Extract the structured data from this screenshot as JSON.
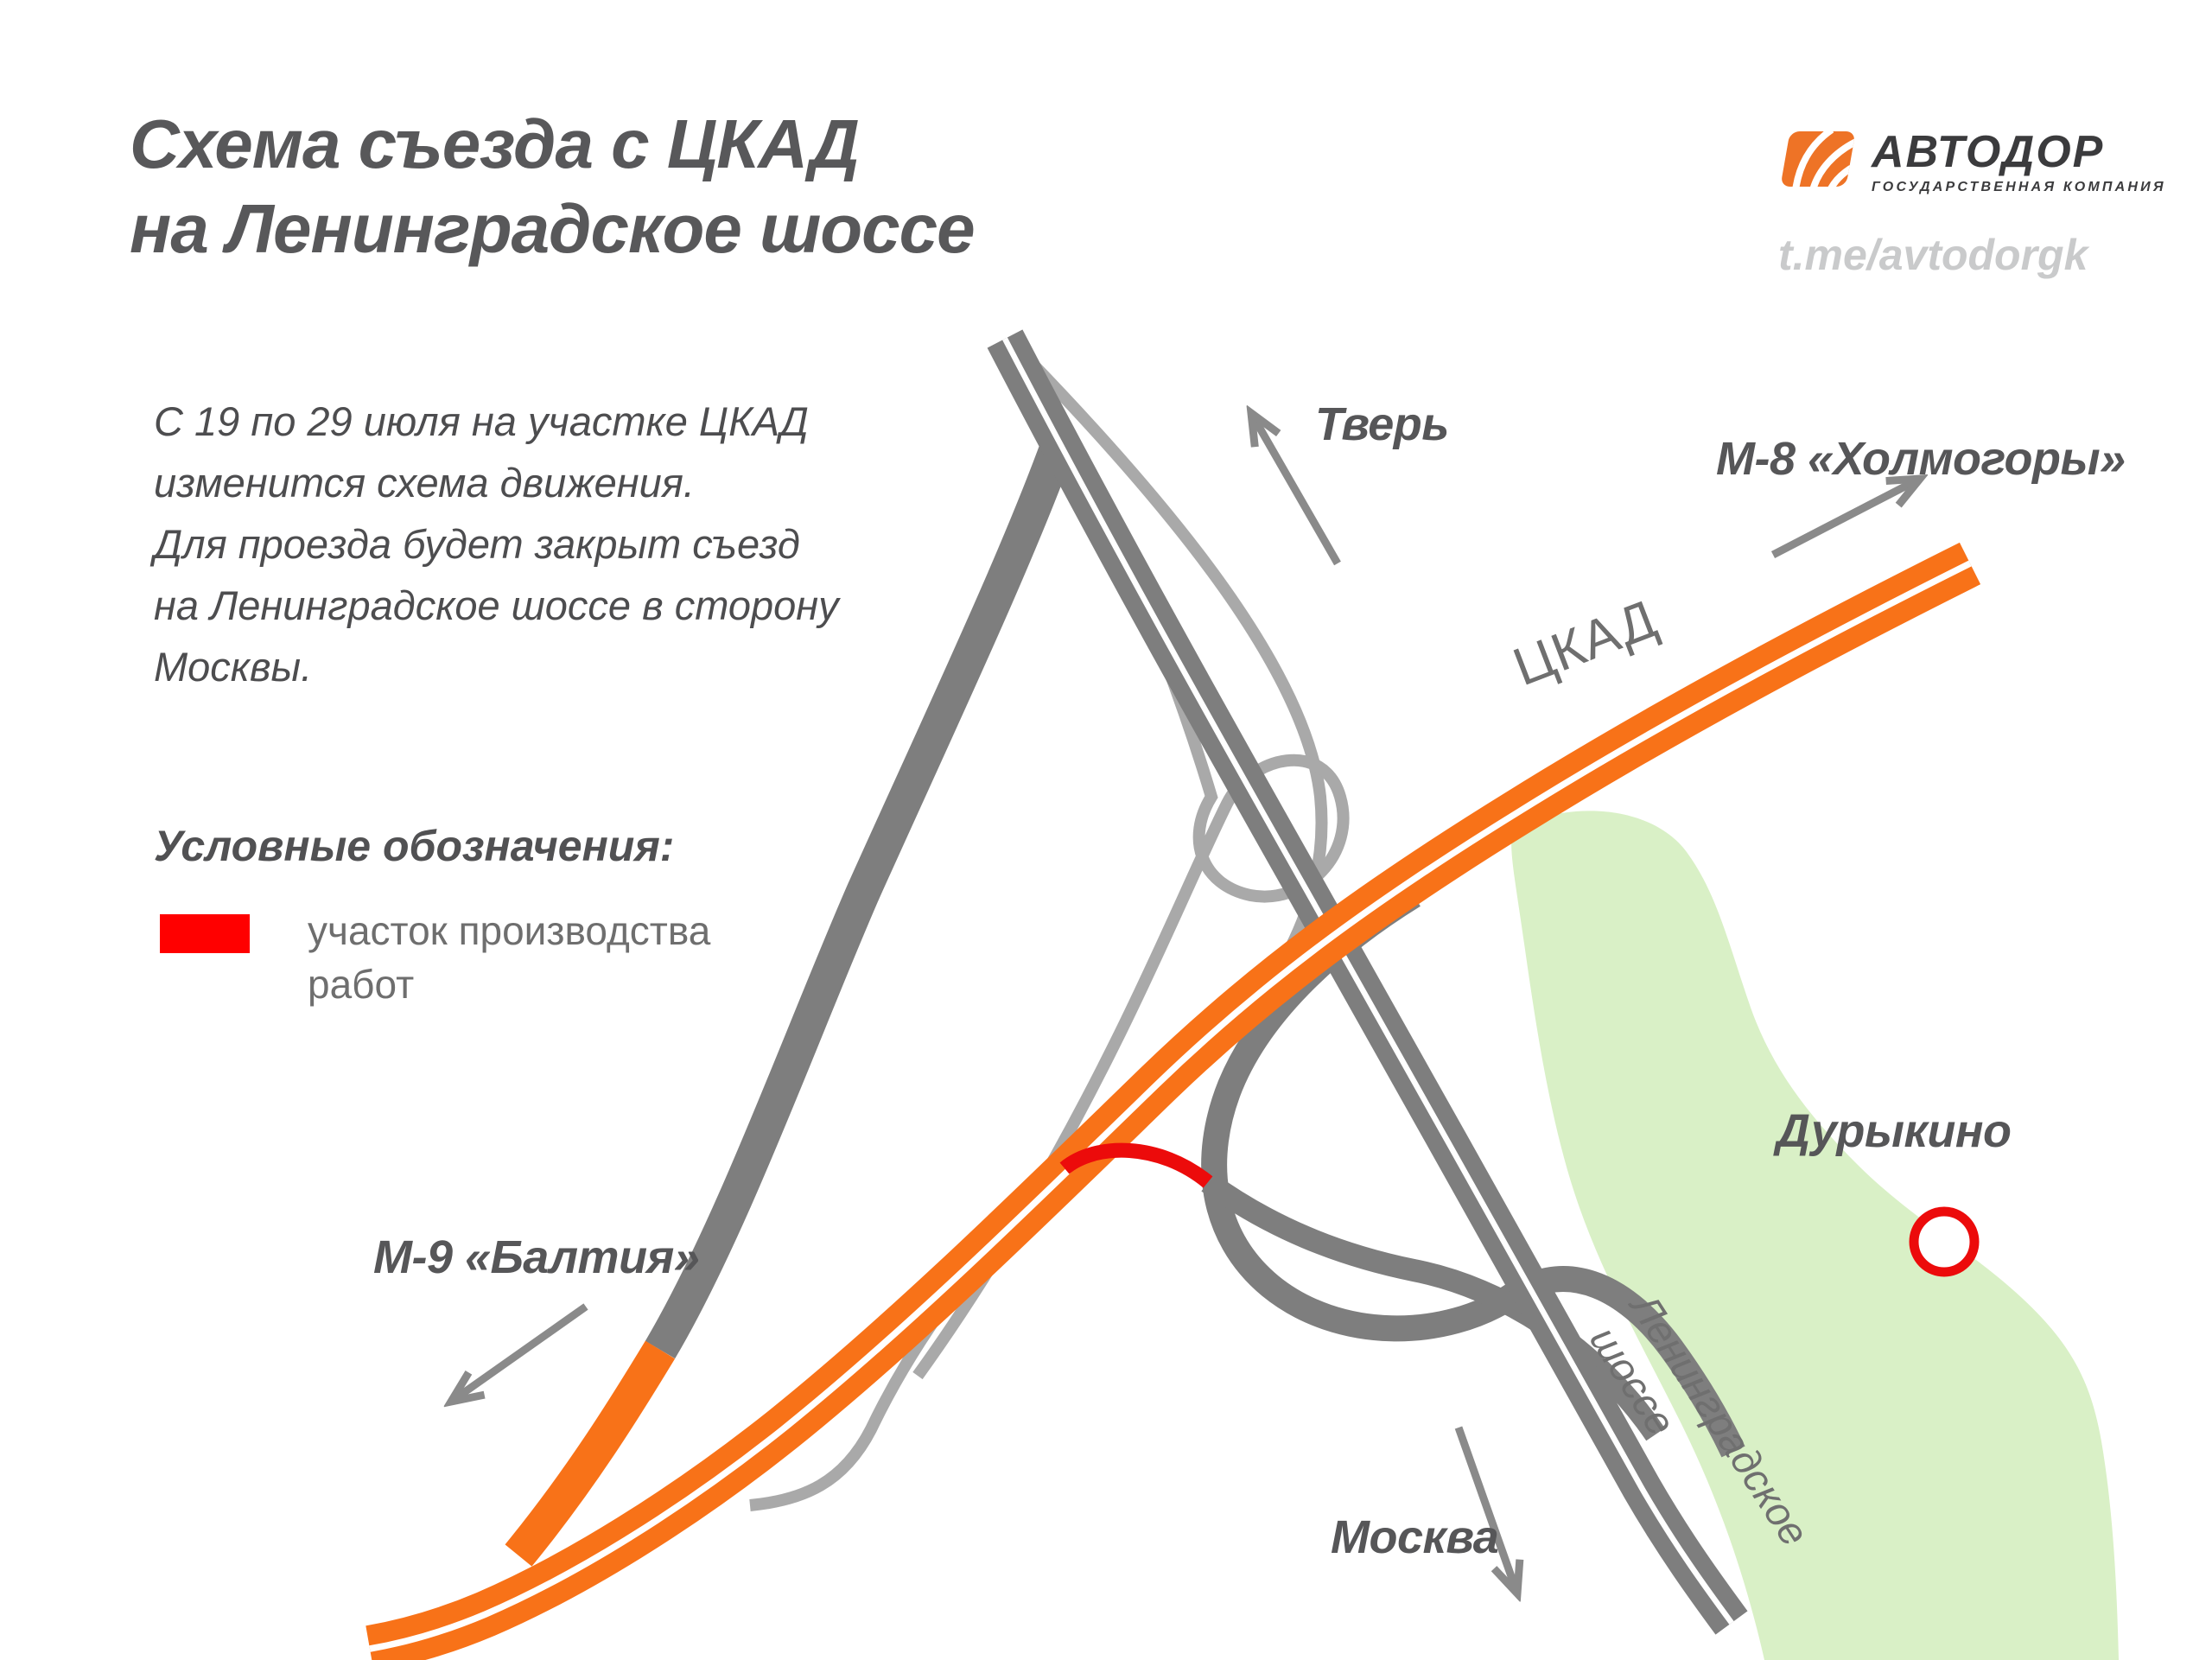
{
  "header": {
    "title_line1": "Схема съезда с ЦКАД",
    "title_line2": "на Ленинградское шоссе",
    "logo": {
      "brand": "АВТОДОР",
      "tagline": "ГОСУДАРСТВЕННАЯ КОМПАНИЯ",
      "mark_color": "#EE7326",
      "text_color": "#3B3B3D"
    },
    "telegram": "t.me/avtodorgk"
  },
  "description": {
    "line1": "С 19 по 29 июля на участке ЦКАД",
    "line2": "изменится схема движения.",
    "line3": "Для проезда будет закрыт съезд",
    "line4": "на Ленинградское шоссе в сторону",
    "line5": "Москвы."
  },
  "legend": {
    "heading": "Условные обозначения:",
    "item": {
      "swatch_color": "#FF0000",
      "line1": "участок производства",
      "line2": "работ"
    }
  },
  "map": {
    "labels": {
      "tver": "Тверь",
      "m8": "М-8 «Холмогоры»",
      "ckad": "ЦКАД",
      "m9": "М-9 «Балтия»",
      "moscow": "Москва",
      "durykino": "Дурыкино",
      "len_shosse_line1": "Ленинградское",
      "len_shosse_line2": "шоссе"
    },
    "colors": {
      "ckad_road": "#F87218",
      "main_road": "#7E7E7E",
      "ramp_road": "#A9A9A9",
      "closed_section": "#EC0B0B",
      "settlement_area": "#D9F0C6",
      "arrow": "#8A8A8A"
    }
  }
}
